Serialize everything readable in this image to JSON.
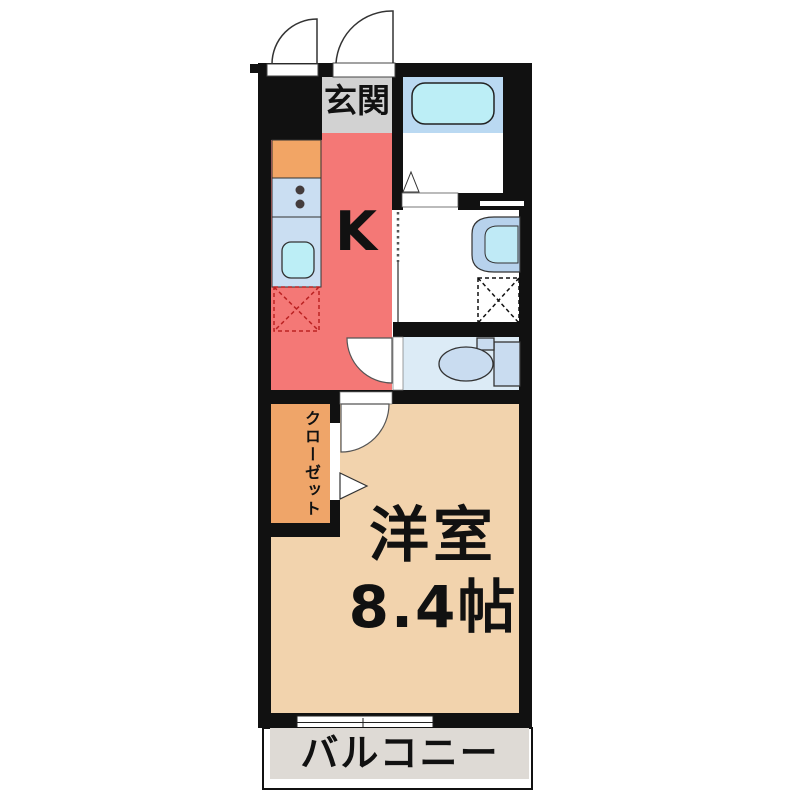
{
  "floorplan": {
    "rooms": {
      "entrance": {
        "label": "玄関"
      },
      "kitchen": {
        "label": "K"
      },
      "closet": {
        "label": "クローゼット"
      },
      "main_room": {
        "label": "洋室",
        "size": "8.4帖"
      },
      "balcony": {
        "label": "バルコニー"
      }
    },
    "fixtures": [
      "bathtub",
      "bath-folding-door",
      "washbasin",
      "washing-machine-space",
      "toilet",
      "kitchen-counter",
      "stove-burners",
      "kitchen-sink",
      "refrigerator-space",
      "accordion-door",
      "entrance-doors",
      "closet-folding-door",
      "sliding-window"
    ],
    "colors": {
      "wall": "#111111",
      "kitchen_floor": "#f47876",
      "entrance_floor": "#d2d2d2",
      "room_floor": "#f2d3ad",
      "closet_fill": "#efa569",
      "counter_top": "#f2a565",
      "counter_unit": "#cadef2",
      "sink_cyan": "#bceef6",
      "bath_platform": "#bad9f2",
      "washbasin_fill": "#b7d2ec",
      "washbasin_bowl": "#bfeaf6",
      "toilet_floor": "#dcebf6",
      "toilet_fixture": "#c9dcf0",
      "balcony_floor": "#dedad5",
      "refrigerator_dash": "#bb2222"
    }
  }
}
